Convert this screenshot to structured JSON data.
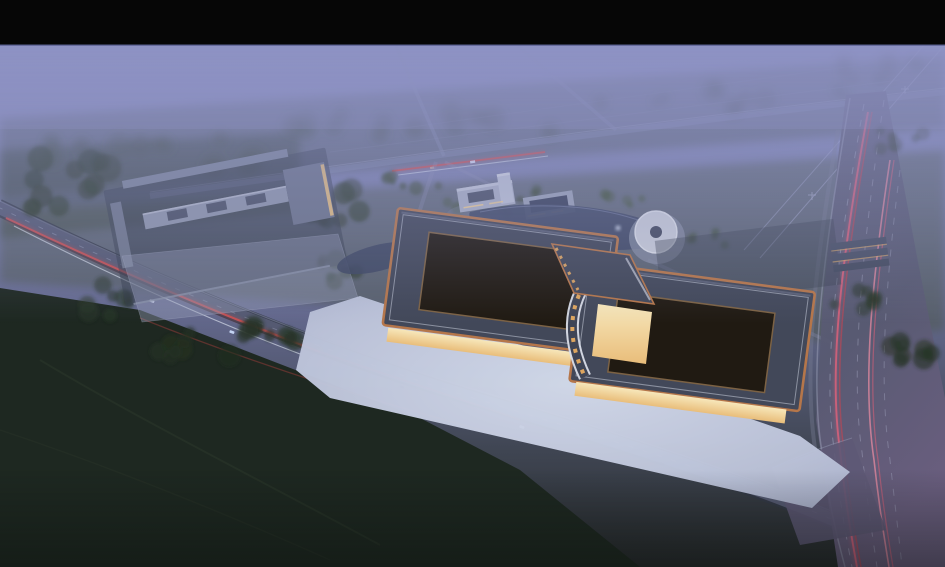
{
  "scene": {
    "type": "aerial-architectural-rendering",
    "time_of_day": "dusk",
    "subject": "agricultural-trade-market-campus",
    "elements": {
      "letterbox_bar": "black bar across top of frame",
      "main_hall_west": "large market hall, dark hip roof with copper trim and open lattice courtyard",
      "main_hall_east": "second market hall, dark hip roof with curved white eave and lit slots",
      "entrance_gate": "glowing central gate pavilion between the two halls",
      "forecourt_plaza": "illuminated forecourt with parking rows and teal skylights",
      "secondary_market_complex": "row-roofed market buildings with lit lanes, north-west of site",
      "secondary_parking": "parking lot with cars and trees",
      "office_building": "mid-rise office block by the pond",
      "pond": "landscape pond with fountain",
      "round_pavilion": "circular radial-roof pavilion at pond edge",
      "dormitory_rows": "rows of low buildings with warm lit fronts, east side",
      "boulevard": "tree-lined boulevard with tail-light trails along the site front",
      "highway": "wide arterial road with pink light trails, right edge",
      "upper_road": "foggy rural road with red light trail behind the site",
      "farmland": "hazy farmland and tree belts fading into fog",
      "power_lines": "transmission lines crossing fields, top right"
    },
    "palette": {
      "letterbox": "#060606",
      "seam_blue": "#4a5080",
      "fog_top": "#8e93c4",
      "fog_mid": "#7a7fab",
      "fog_low": "#63688c",
      "horizon_green": "#3c4a37",
      "field_green": "#49543f",
      "field_dark": "#1e2821",
      "tree_dark": "#1c2a1c",
      "road": "#5a5f78",
      "road_faint": "#8289ad",
      "highway_gray": "#60607a",
      "highway_purple": "#6b5f80",
      "plaza_bright": "#d3daea",
      "plaza_edge": "#a9b0ca",
      "roof_slate": "#424859",
      "roof_trim": "#b5764a",
      "lattice_wood": "#5e4a33",
      "lattice_green": "#55683a",
      "glow_warm": "#f4d9a0",
      "facade_amber": "#e9bd7a",
      "canopy_white": "#dde3ee",
      "canopy_dark": "#4d556e",
      "water": "#404a66",
      "teal_light": "#5fc8d8",
      "trail_red": "#c84848",
      "trail_pink": "#d4607a",
      "lamp_orange": "#f0a848",
      "headlight_white": "#e8eef8"
    }
  }
}
